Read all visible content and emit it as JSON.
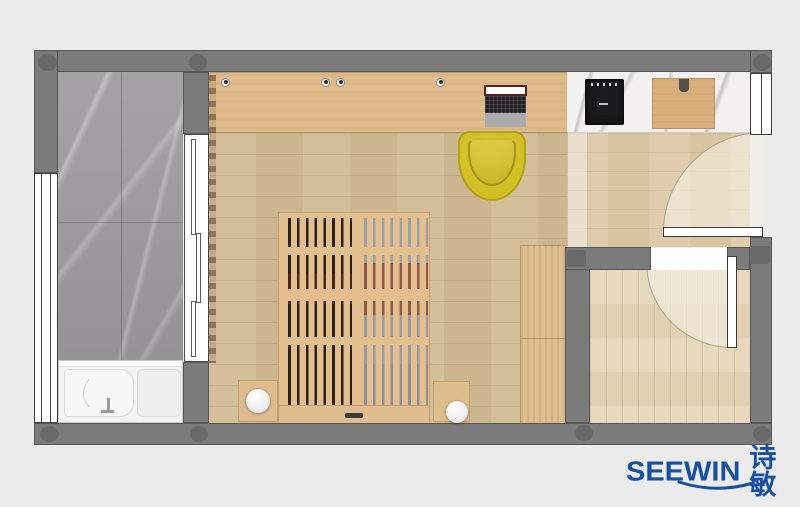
{
  "brand": {
    "wordmark": "SEEWIN",
    "chinese": "诗敏",
    "color": "#17509f"
  },
  "palette": {
    "canvasBg": "#ebebeb",
    "wall": "#7b7b7b",
    "wallColumn": "#696969",
    "bathMarble": "#9e9c9e",
    "bedroomFloor": "#d3bc96",
    "hallFloor": "#dcc9a7",
    "storageFloor": "#e6d5b8",
    "deskWood": "#dfba8b",
    "counterMarble": "#f3f1ef",
    "bedWood": "#e3bf8f",
    "chairYellow": "#d0bd24",
    "cooktopBlack": "#1b1b1d",
    "cuttingBoard": "#d9af7c",
    "tubWhite": "#f3f3f3",
    "arcTint": "rgba(246,240,230,0.6)",
    "brand": "#17509f"
  },
  "plan": {
    "rooms": [
      {
        "name": "bathroom",
        "floor": "gray-marble"
      },
      {
        "name": "bedroom",
        "floor": "oak-plank"
      },
      {
        "name": "entry-hall",
        "floor": "oak-plank-light"
      },
      {
        "name": "storage-room",
        "floor": "oak-plank-pale"
      }
    ],
    "objects": [
      "bathtub",
      "bath-sliding-door",
      "window-left",
      "window-kitchen",
      "desk",
      "laptop",
      "yellow-desk-chair",
      "induction-cooktop",
      "cutting-board",
      "marble-counter",
      "slatted-bed",
      "nightstand-left",
      "nightstand-right",
      "ball-lamp-left",
      "ball-lamp-right",
      "wardrobe",
      "entry-door",
      "storage-door",
      "curtain",
      "glass-partition"
    ]
  }
}
